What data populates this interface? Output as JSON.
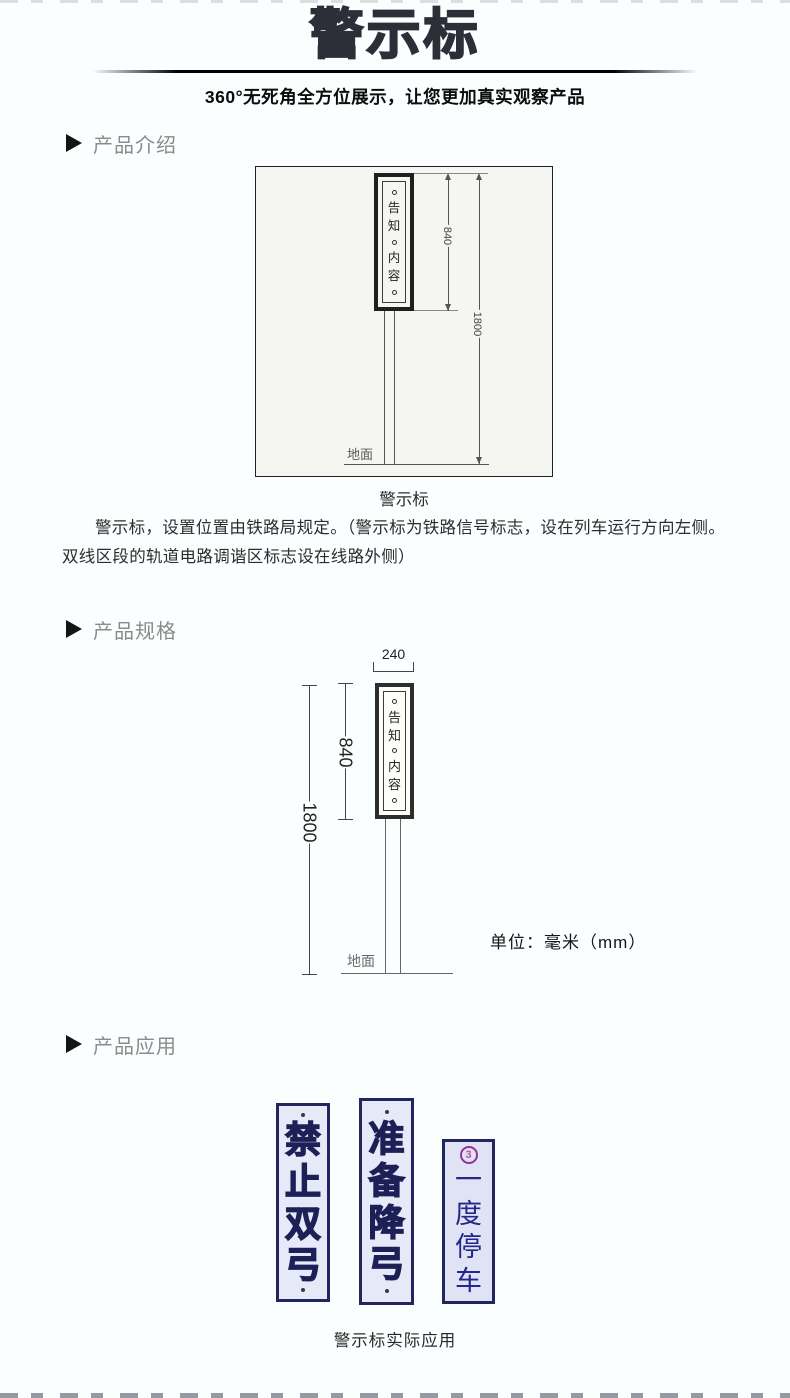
{
  "header": {
    "title": "警示标",
    "subtitle": "360°无死角全方位展示，让您更加真实观察产品"
  },
  "sections": {
    "intro": {
      "label": "产品介绍"
    },
    "spec": {
      "label": "产品规格"
    },
    "app": {
      "label": "产品应用"
    }
  },
  "diagram_intro": {
    "sign_top": "告知",
    "sign_bottom": "内容",
    "dim_sign_height": "840",
    "dim_total_height": "1800",
    "ground_label": "地面",
    "caption": "警示标"
  },
  "intro_paragraph": "警示标，设置位置由铁路局规定。（警示标为铁路信号标志，设在列车运行方向左侧。双线区段的轨道电路调谐区标志设在线路外侧）",
  "diagram_spec": {
    "sign_top": "告知",
    "sign_bottom": "内容",
    "dim_width": "240",
    "dim_sign_height": "840",
    "dim_total_height": "1800",
    "ground_label": "地面",
    "unit_note": "单位：毫米（mm）"
  },
  "application": {
    "signs": [
      {
        "text": "禁止双弓",
        "weight": "bold"
      },
      {
        "text": "准备降弓",
        "weight": "bold"
      },
      {
        "text": "一度停车",
        "weight": "regular",
        "emblem": "3"
      }
    ],
    "caption": "警示标实际应用"
  },
  "colors": {
    "page_bg": "#fbfeff",
    "title": "#2e2e38",
    "section_label": "#8b8b8b",
    "sign_border": "#23255e",
    "sign_text": "#1d2056",
    "sign_bg": "#e6e9f7",
    "emblem": "#a8439d",
    "drawing_line": "#555555"
  }
}
